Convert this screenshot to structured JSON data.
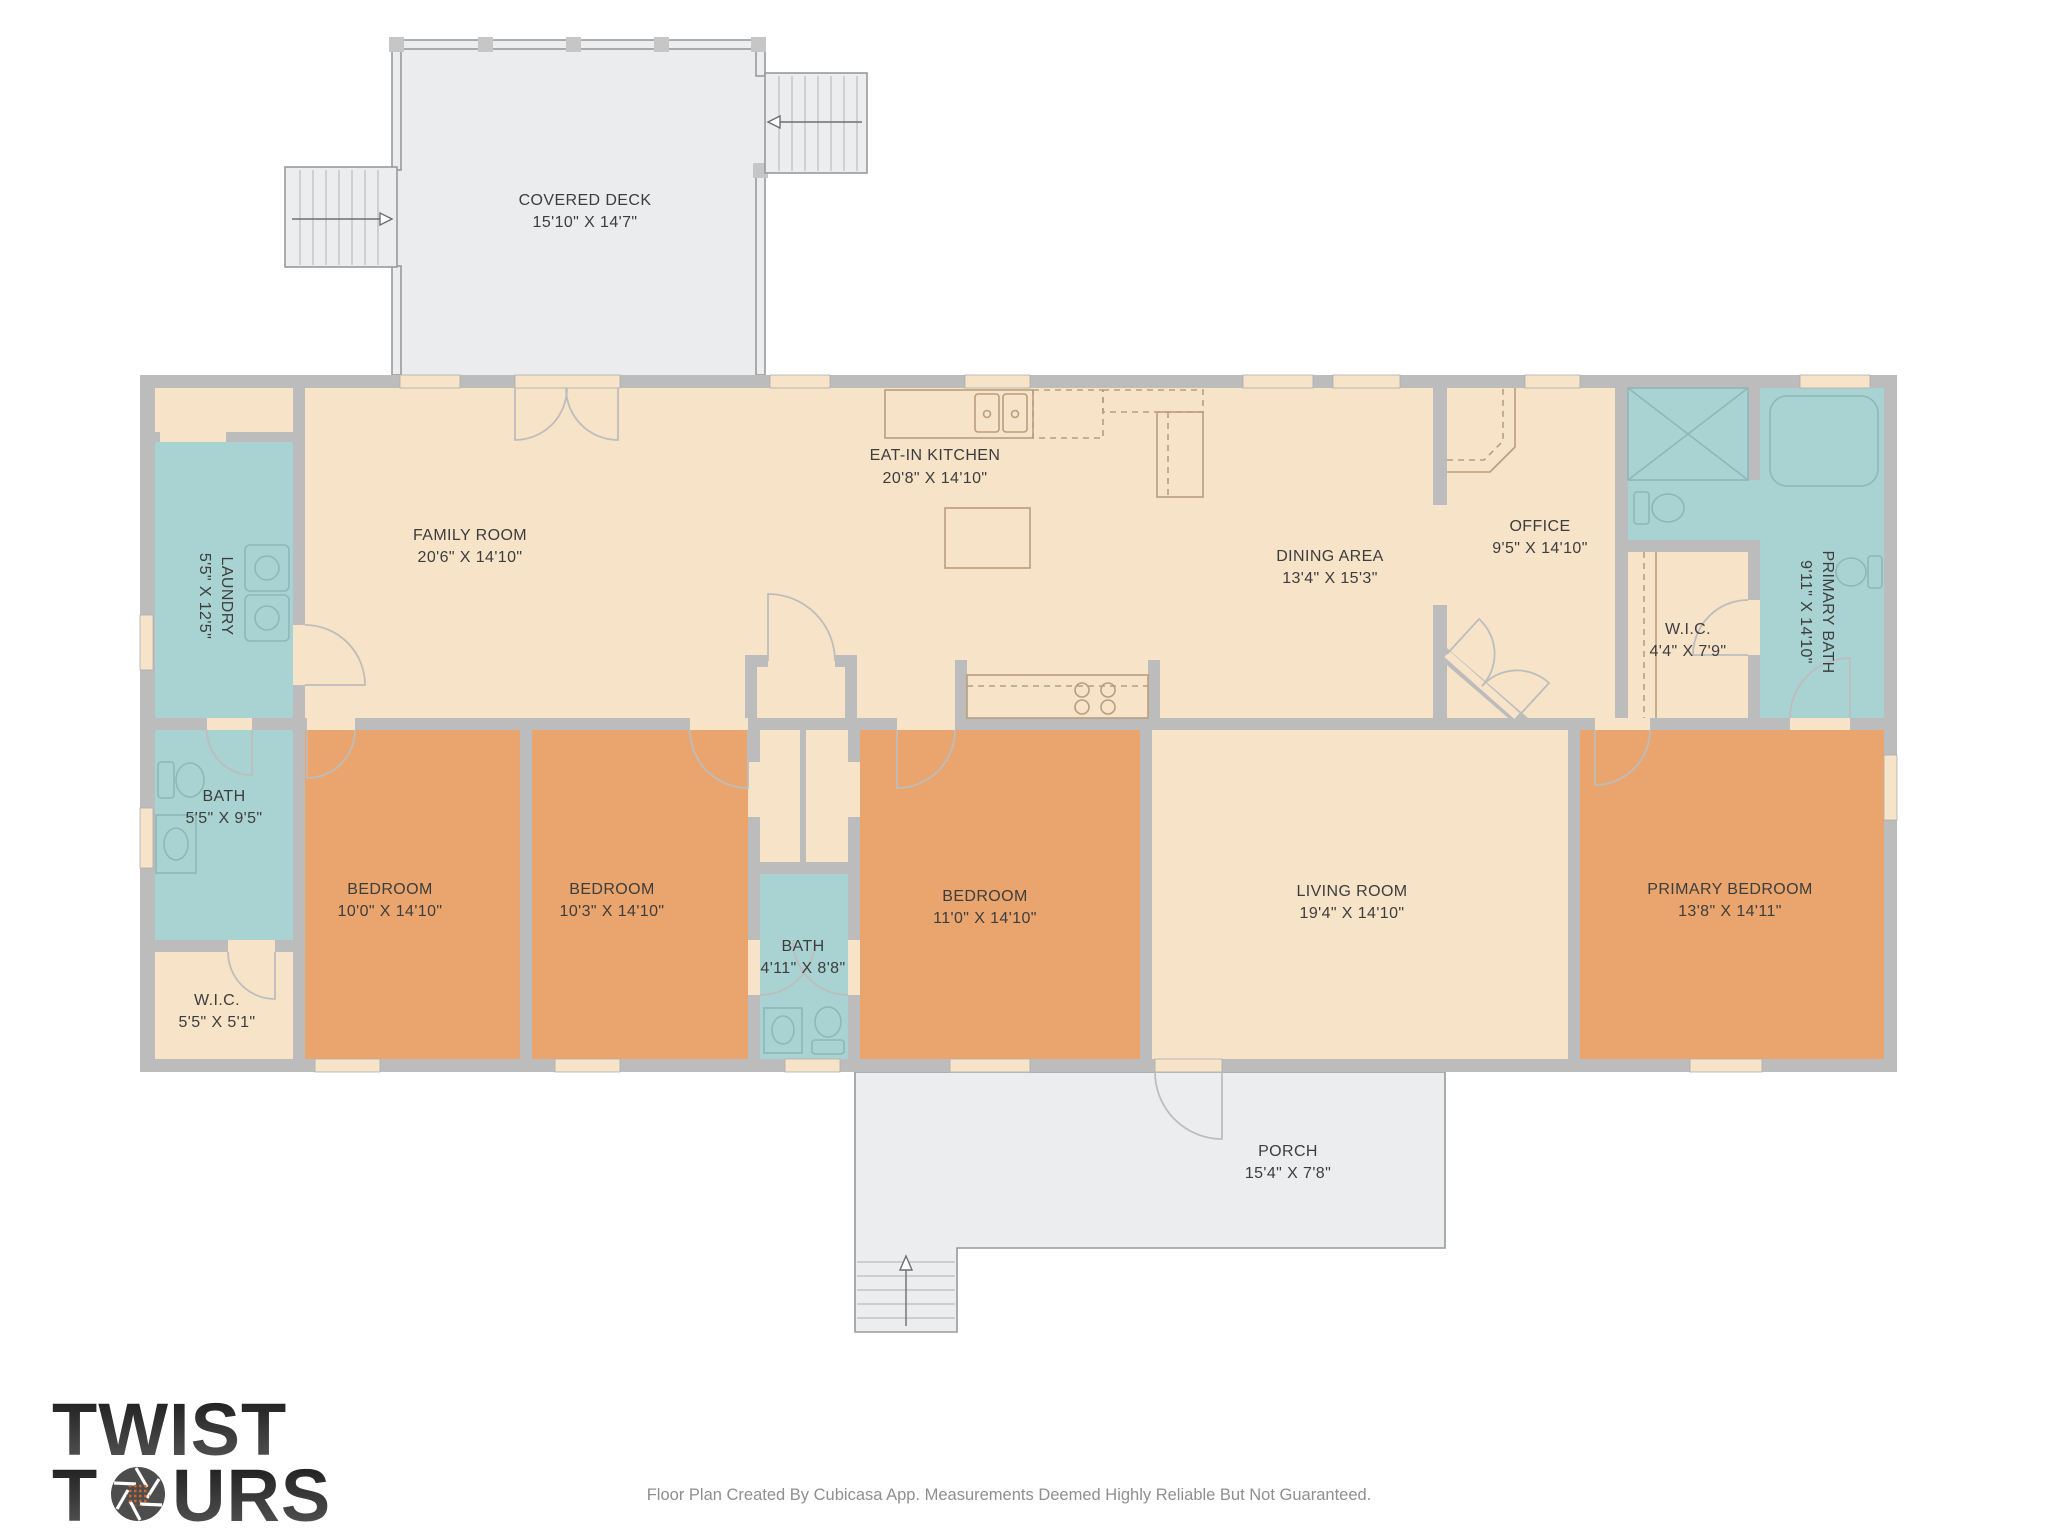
{
  "meta": {
    "app_footer": "Floor Plan Created By Cubicasa App. Measurements Deemed Highly Reliable But Not Guaranteed."
  },
  "logo": {
    "line1": "TWIST",
    "line2_pre": "T",
    "line2_post": "URS"
  },
  "colors": {
    "floor_common": "#f6e3c8",
    "floor_bedroom": "#e9a56d",
    "floor_wet": "#a9d2d2",
    "wall": "#bcbcbc",
    "outdoor": "#ebeced",
    "accent_orange": "#c9672e",
    "label_text": "#3d3d3d"
  },
  "rooms": {
    "covered_deck": {
      "name": "COVERED DECK",
      "dims": "15'10\" X 14'7\""
    },
    "family": {
      "name": "FAMILY ROOM",
      "dims": "20'6\" X 14'10\""
    },
    "kitchen": {
      "name": "EAT-IN KITCHEN",
      "dims": "20'8\" X 14'10\""
    },
    "dining": {
      "name": "DINING AREA",
      "dims": "13'4\" X 15'3\""
    },
    "office": {
      "name": "OFFICE",
      "dims": "9'5\" X 14'10\""
    },
    "laundry": {
      "name": "LAUNDRY",
      "dims": "5'5\" X 12'5\""
    },
    "primary_bath": {
      "name": "PRIMARY BATH",
      "dims": "9'11\" X 14'10\""
    },
    "wic_primary": {
      "name": "W.I.C.",
      "dims": "4'4\" X 7'9\""
    },
    "bath_left": {
      "name": "BATH",
      "dims": "5'5\" X 9'5\""
    },
    "wic_left": {
      "name": "W.I.C.",
      "dims": "5'5\" X 5'1\""
    },
    "bedroom1": {
      "name": "BEDROOM",
      "dims": "10'0\" X 14'10\""
    },
    "bedroom2": {
      "name": "BEDROOM",
      "dims": "10'3\" X 14'10\""
    },
    "bath_mid": {
      "name": "BATH",
      "dims": "4'11\" X 8'8\""
    },
    "bedroom3": {
      "name": "BEDROOM",
      "dims": "11'0\" X 14'10\""
    },
    "living": {
      "name": "LIVING ROOM",
      "dims": "19'4\" X 14'10\""
    },
    "primary_bedroom": {
      "name": "PRIMARY BEDROOM",
      "dims": "13'8\" X 14'11\""
    },
    "porch": {
      "name": "PORCH",
      "dims": "15'4\" X 7'8\""
    }
  }
}
